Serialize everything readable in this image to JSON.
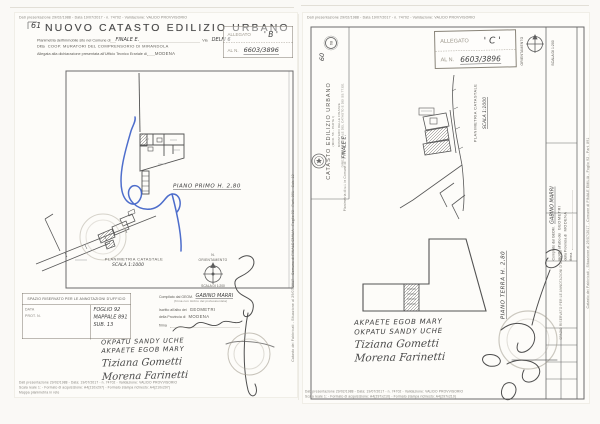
{
  "meta": {
    "background_color": "#faf9f6",
    "ink_color": "#4a4a4a",
    "pen_blue_color": "#2f55c4",
    "stamp_color": "#a39d90"
  },
  "left_page": {
    "micro_top": "Dati presentazione 29/02/1988 - Data 19/07/2017 - n. 74702 - Validazione: VALIDO PROVVISORIO",
    "doc_no": "61",
    "title": "NUOVO CATASTO EDILIZIO URBANO",
    "field1_label": "Planimetria dell'immobile sito nel Comune di",
    "field1_value": "FINALE E.",
    "field1b_label": "Via",
    "field1b_value": "DELFI 6",
    "field2_label": "Ditta",
    "field2_value": "COOP. MURATORI DEL COMPRENSORIO DI MIRANDOLA",
    "field3_label": "Allegata alla dichiarazione presentata all'Ufficio Tecnico Erariale di",
    "field3_value": "MODENA",
    "allegato_label": "ALLEGATO",
    "allegato_value": "' B '",
    "aln_label": "AL N.",
    "aln_value": "6603/3896",
    "plan_caption": "PIANO PRIMO H. 2,80",
    "site_caption": "PLANIMETRIA CATASTALE",
    "site_scale": "SCALA 1:1000",
    "compass_n": "N.",
    "compass_label": "ORIENTAMENTO",
    "compass_scale": "SCALA DI 1:200",
    "annot_header": "SPAZIO RISERVATO PER LE ANNOTAZIONI D'UFFICIO",
    "annot_data": "DATA",
    "annot_prot": "PROT. N.",
    "annot_foglio": "FOGLIO 92",
    "annot_mappale": "MAPPALE 891",
    "annot_sub": "SUB. 13",
    "comp_label": "Compilato dal GEOM.",
    "comp_name": "GABINO MARRI",
    "comp_note": "(firma con timbro del professionista)",
    "albo_label": "Iscritto all'albo dei",
    "albo_value": "GEOMETRI",
    "prov_label": "della Provincia di",
    "prov_value": "MODENA",
    "firma_label": "firma",
    "names": [
      "OKPATU SANDY UCHE",
      "AKPAETE EGOB MARY",
      "Tiziana Gometti",
      "Morena Farinetti"
    ],
    "micro_bottom1": "Dati presentazione 29/02/1988 - Data: 19/07/2017 - n. 74702 - Validazione: VALIDO PROVVISORIO",
    "micro_bottom2": "Scala reale 1: - Formato di acquisizione: A4(210x297) - Formato stampa richiesto: A4(210x297)",
    "micro_bottom3": "Mappa planimetria in rete",
    "side_micro": "Catasto dei Fabbricati - Situazione al 29/07/2017 - Comune di FINALE EMILIA - Foglio 92 - Part. 891 - Sub. 13"
  },
  "right_page": {
    "micro_top": "Dati presentazione 29/02/1988 - Data 19/07/2017 - n. 74702 - Validazione: VALIDO PROVVISORIO",
    "doc_no": "60",
    "badge_no": "68",
    "admin_line1": "MINISTERO DELLE FINANZE",
    "admin_line2": "DIREZIONE GENERALE DEL CATASTO E DEI SS.TT.EE.",
    "admin_title": "CATASTO EDILIZIO URBANO",
    "admin_mod": "(MOD. 58 - PARTE I)",
    "admin_sub": "Planimetria di u.i. in Comune di",
    "admin_sub_value": "FINALE E.",
    "allegato_label": "ALLEGATO",
    "allegato_value": "' C '",
    "aln_label": "AL N.",
    "aln_value": "6603/3896",
    "compass_label": "ORIENTAMENTO",
    "strip_scale": "SCALA DI 1:200",
    "strip_comp_label": "Compilato dal GEOM.",
    "strip_comp_name": "GABINO MARRI",
    "strip_albo_label": "Iscritto all'albo dei",
    "strip_albo_value": "GEOMETRI",
    "strip_prov_label": "della Provincia di",
    "strip_prov_value": "MODENA",
    "strip_firma": "firma",
    "strip_annot_header": "SPAZIO RISERVATO PER LE ANNOTAZIONI D'UFFICIO",
    "site_caption": "PLANIMETRIA CATASTALE",
    "site_scale": "SCALA 1:1000",
    "plan_caption": "PIANO TERRA H. 2,80",
    "names": [
      "AKPAETE EGOB MARY",
      "OKPATU SANDY UCHE",
      "Tiziana Gometti",
      "Morena Farinetti"
    ],
    "micro_bottom1": "Dati presentazione 29/02/1988 - Data: 19/07/2017 - n. 74702 - Validazione: VALIDO PROVVISORIO",
    "micro_bottom2": "Scala reale 1: - Formato di acquisizione: A4(297x210) - Formato stampa richiesto: A4(297x210)",
    "side_micro": "Catasto dei Fabbricati - Situazione al 29/07/2017 - Comune di FINALE EMILIA - Foglio 92 - Part. 891"
  }
}
